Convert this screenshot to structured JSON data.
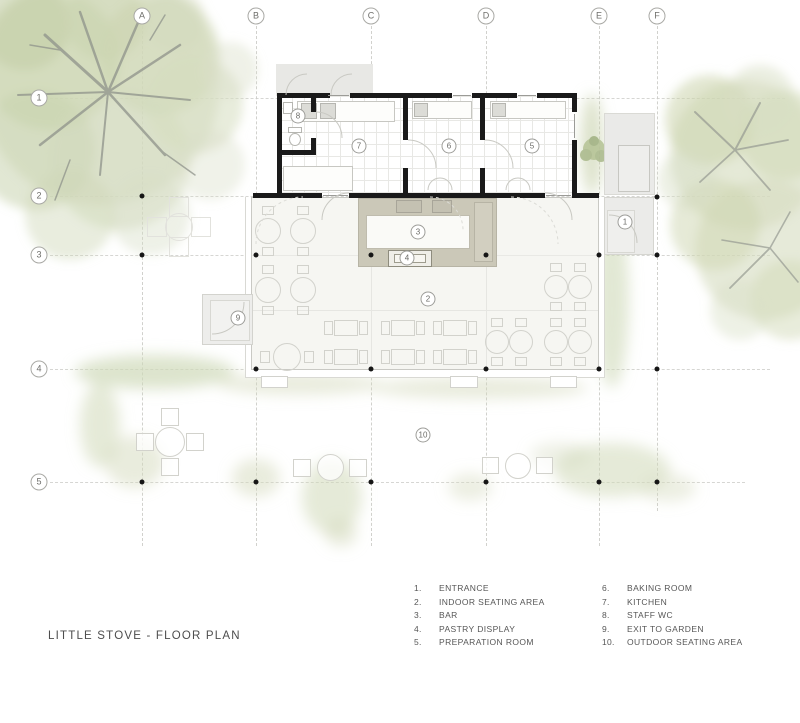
{
  "title": "LITTLE STOVE - FLOOR PLAN",
  "grid": {
    "columns": [
      "A",
      "B",
      "C",
      "D",
      "E",
      "F"
    ],
    "rows": [
      "1",
      "2",
      "3",
      "4",
      "5"
    ]
  },
  "rooms": [
    {
      "number": "1",
      "label": "ENTRANCE"
    },
    {
      "number": "2",
      "label": "INDOOR SEATING AREA"
    },
    {
      "number": "3",
      "label": "BAR"
    },
    {
      "number": "4",
      "label": "PASTRY DISPLAY"
    },
    {
      "number": "5",
      "label": "PREPARATION ROOM"
    },
    {
      "number": "6",
      "label": "BAKING ROOM"
    },
    {
      "number": "7",
      "label": "KITCHEN"
    },
    {
      "number": "8",
      "label": "STAFF WC"
    },
    {
      "number": "9",
      "label": "EXIT TO GARDEN"
    },
    {
      "number": "10",
      "label": "OUTDOOR SEATING AREA"
    }
  ],
  "colors": {
    "wall": "#1a1a1a",
    "bar_counter": "#cbc8b8",
    "indoor_floor": "#f6f6f2",
    "platform_gray": "#ebebe9",
    "foliage_green": "#cfd8b8"
  }
}
